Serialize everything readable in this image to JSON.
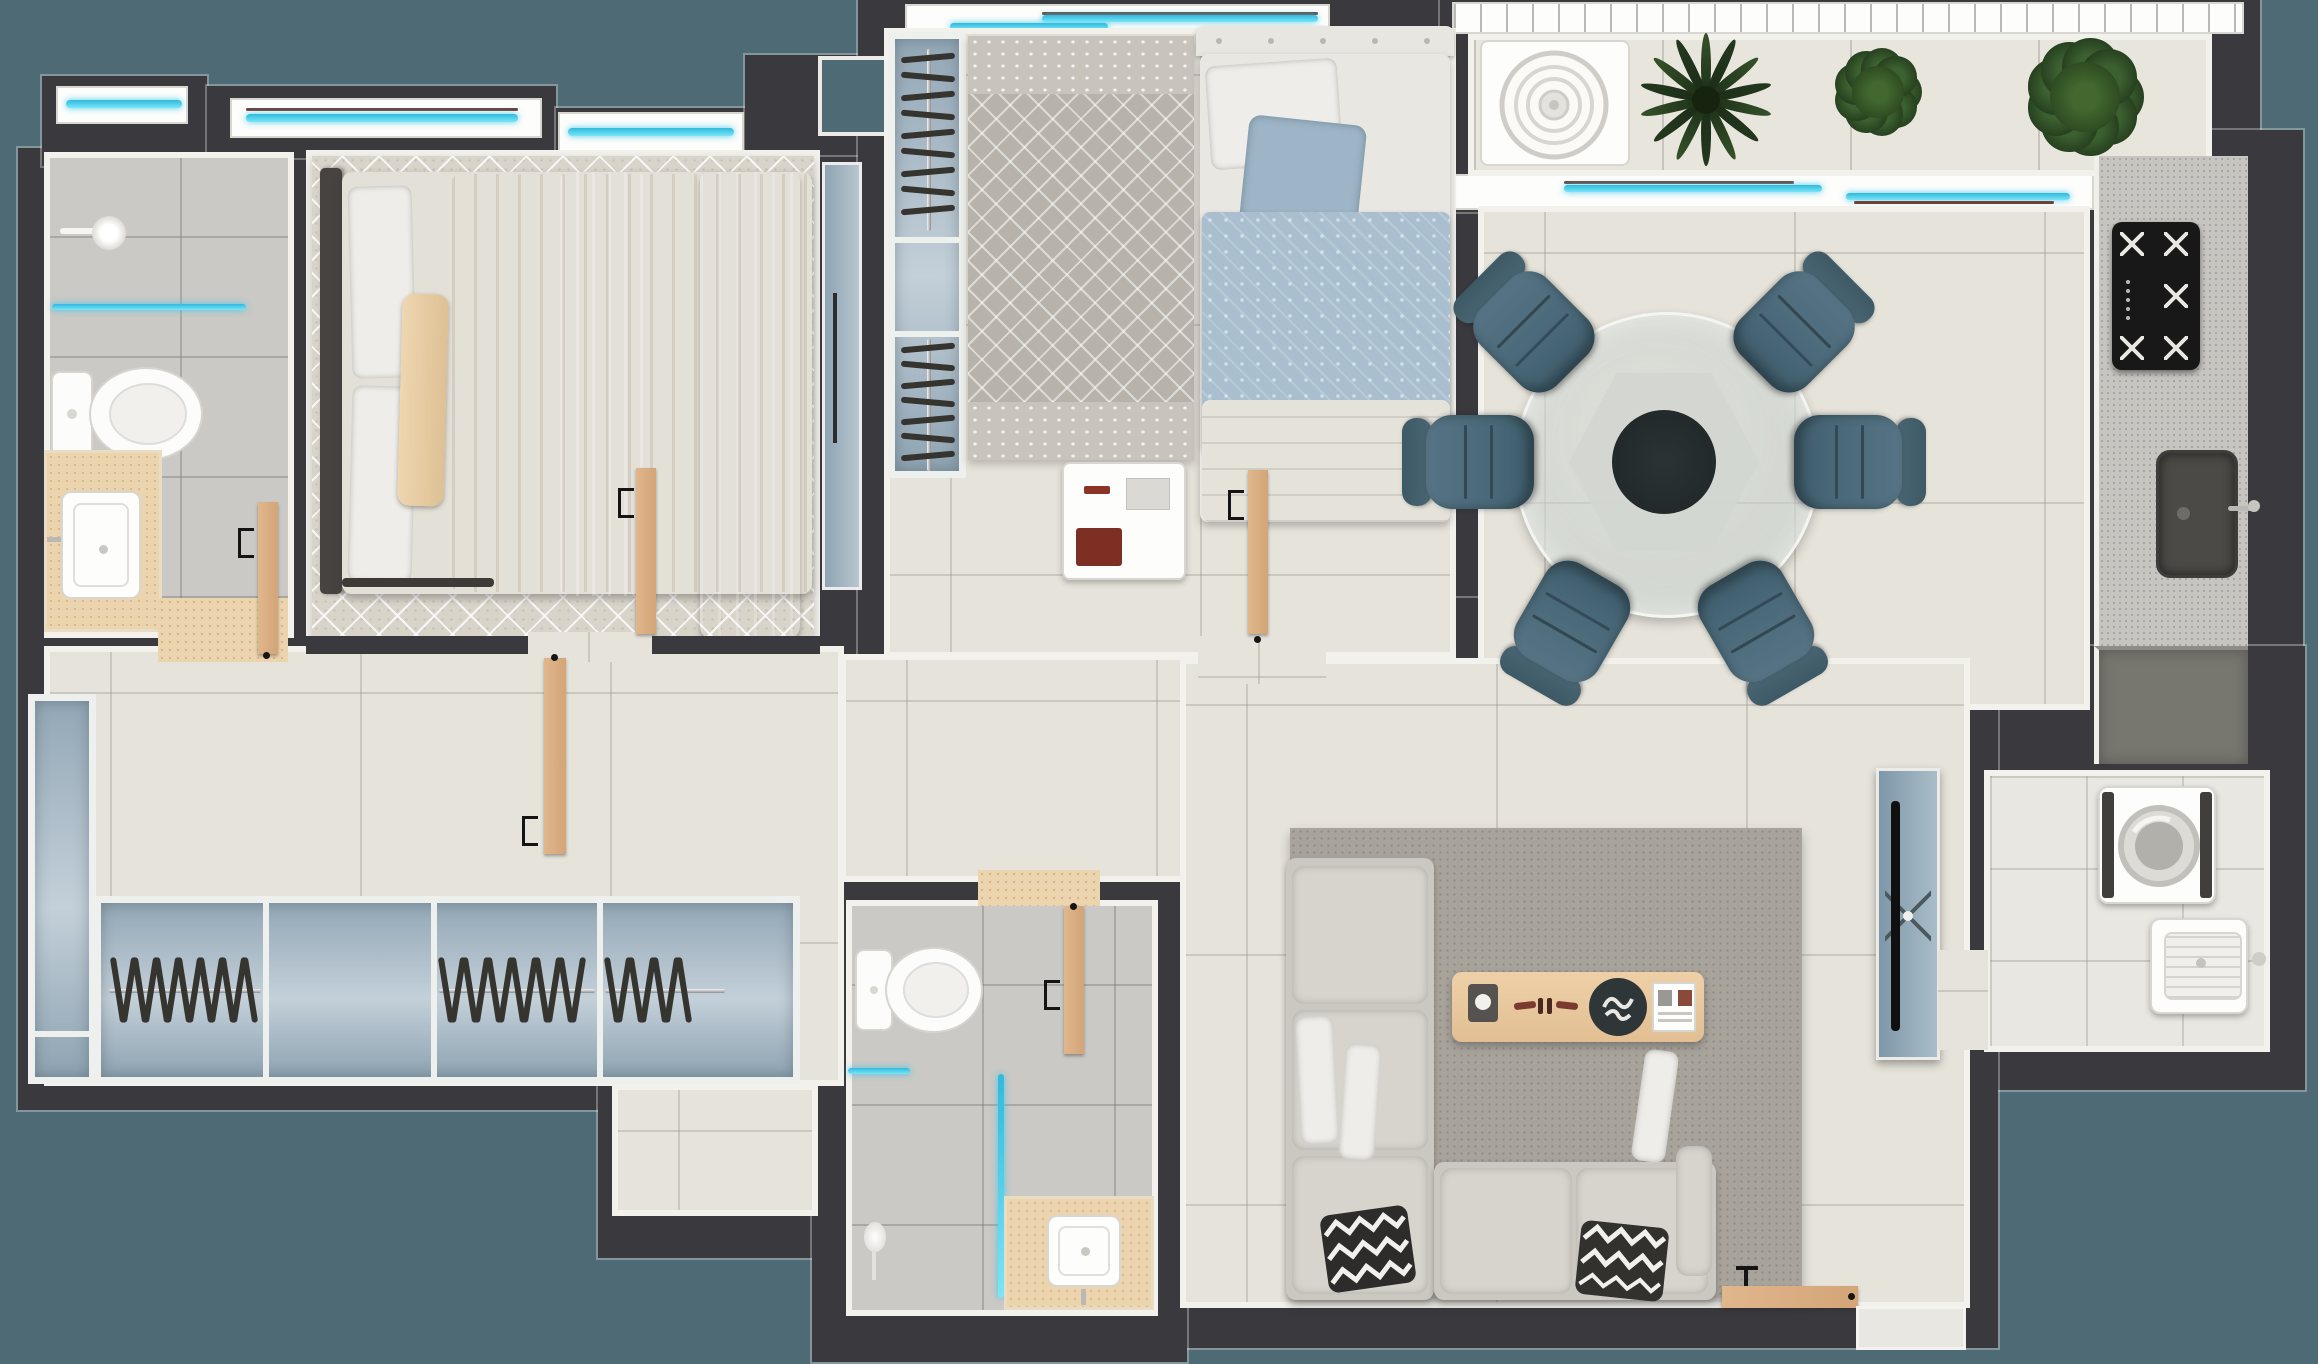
{
  "scene": {
    "type": "apartment-floor-plan-top-view",
    "style": "3d-rendered real-estate plan, no text labels",
    "background_color": "#4e6a75",
    "wall_color": "#3a393d",
    "wall_trim_color": "#f2f1ec",
    "glass_color": "#3fc5e6",
    "door_wood_color": "#d9ae85"
  },
  "palette": {
    "floor_cream": "#e6e3da",
    "floor_gray_tile": "#cac9c5",
    "floor_white_tile": "#e9e7e1",
    "rug_trellis": "#d8d4ca",
    "rug_geometric": "#b7b3ab",
    "rug_living": "#a8a39b",
    "closet_blue": "#a9bcc9",
    "chair_blue": "#4a6978",
    "sofa_gray": "#cbc8c2",
    "counter_beige": "#ecd4ae",
    "kitchen_counter": "#c6c5c0",
    "appliance_black": "#181818",
    "plant_green": "#2c4a28",
    "bed_throw_blue": "#8ea9ba",
    "blanket_beige": "#e6d2b2"
  },
  "rooms": [
    {
      "id": "bathroom-1",
      "label": "en-suite bathroom",
      "fixtures": [
        "shower-head",
        "glass-screen",
        "toilet",
        "vanity-sink",
        "wood-door"
      ]
    },
    {
      "id": "master-bedroom",
      "label": "master bedroom",
      "fixtures": [
        "double-bed",
        "trellis-rug",
        "window",
        "wood-door",
        "sliding-panel"
      ]
    },
    {
      "id": "hall",
      "label": "hallway",
      "fixtures": [
        "wardrobe-run"
      ]
    },
    {
      "id": "bedroom-2",
      "label": "second bedroom",
      "fixtures": [
        "single-bed",
        "geometric-rug",
        "closet",
        "desk",
        "wood-door",
        "window"
      ]
    },
    {
      "id": "balcony",
      "label": "balcony",
      "fixtures": [
        "ac-condenser",
        "plants",
        "sliding-window",
        "louver-roof"
      ]
    },
    {
      "id": "dining",
      "label": "dining area",
      "fixtures": [
        "round-glass-table",
        "six-chairs"
      ]
    },
    {
      "id": "kitchen",
      "label": "kitchen",
      "fixtures": [
        "cooktop",
        "counter-sink",
        "base-cabinet"
      ]
    },
    {
      "id": "living-room",
      "label": "living room",
      "fixtures": [
        "corner-sofa",
        "coffee-table",
        "tv-sideboard",
        "area-rug",
        "entry-door"
      ]
    },
    {
      "id": "bathroom-2",
      "label": "social bathroom",
      "fixtures": [
        "toilet",
        "shower-glass",
        "hand-shower",
        "vanity-sink",
        "wood-door"
      ]
    },
    {
      "id": "laundry",
      "label": "laundry room",
      "fixtures": [
        "washer-top-load",
        "wash-tank-sink"
      ]
    }
  ],
  "hall_closet": {
    "orientation": "horizontal",
    "sections": [
      {
        "type": "hangers",
        "count": 13
      },
      {
        "type": "open-shelf",
        "count": 0
      },
      {
        "type": "hangers",
        "count": 12
      },
      {
        "type": "hangers",
        "count": 7
      }
    ]
  },
  "bedroom2_closet": {
    "orientation": "vertical",
    "sections": [
      {
        "type": "hangers",
        "count": 9
      },
      {
        "type": "open-shelf",
        "count": 0
      },
      {
        "type": "hangers",
        "count": 7
      }
    ]
  },
  "dining": {
    "seat_count": 6,
    "chair_angles_deg": [
      45,
      90,
      150,
      210,
      270,
      315
    ],
    "table": {
      "shape": "round-glass",
      "center_color": "#242b2c"
    }
  },
  "balcony": {
    "has_ac_condenser": true,
    "plants": [
      {
        "type": "palm",
        "size": "large"
      },
      {
        "type": "bush",
        "size": "medium"
      },
      {
        "type": "bush",
        "size": "large"
      }
    ]
  },
  "kitchen": {
    "stove_burners": 5,
    "sink_count": 1
  },
  "laundry": {
    "washer_count": 1,
    "tank_sink_count": 1
  },
  "beds": {
    "master": {
      "pillows": [
        "white",
        "white",
        "beige-lumbar"
      ],
      "throws": [
        "blue",
        "beige",
        "blue"
      ]
    },
    "second": {
      "pillows": [
        "white",
        "light-blue"
      ],
      "duvet": "blue-diamond-print"
    }
  },
  "doors": {
    "wood_leaf_count": 6,
    "entry_door_position": "living-room-south-wall"
  },
  "windows": {
    "glazed_strips": 7,
    "glass_color": "#3fc5e6"
  }
}
